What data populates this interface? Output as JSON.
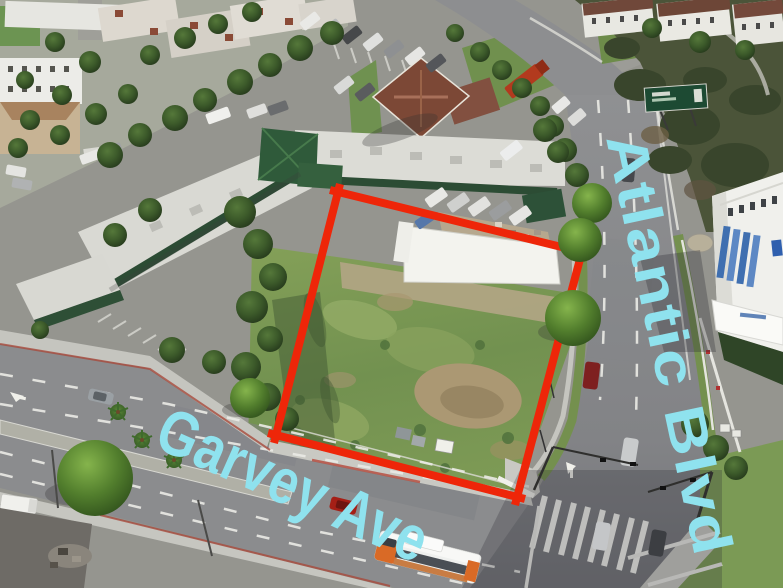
{
  "annotations": {
    "street_label_bottom": "Garvey Ave",
    "street_label_right": "Atlantic Blvd",
    "label_color": "#8FE2EE",
    "parcel_outline_color": "#EE2609"
  }
}
